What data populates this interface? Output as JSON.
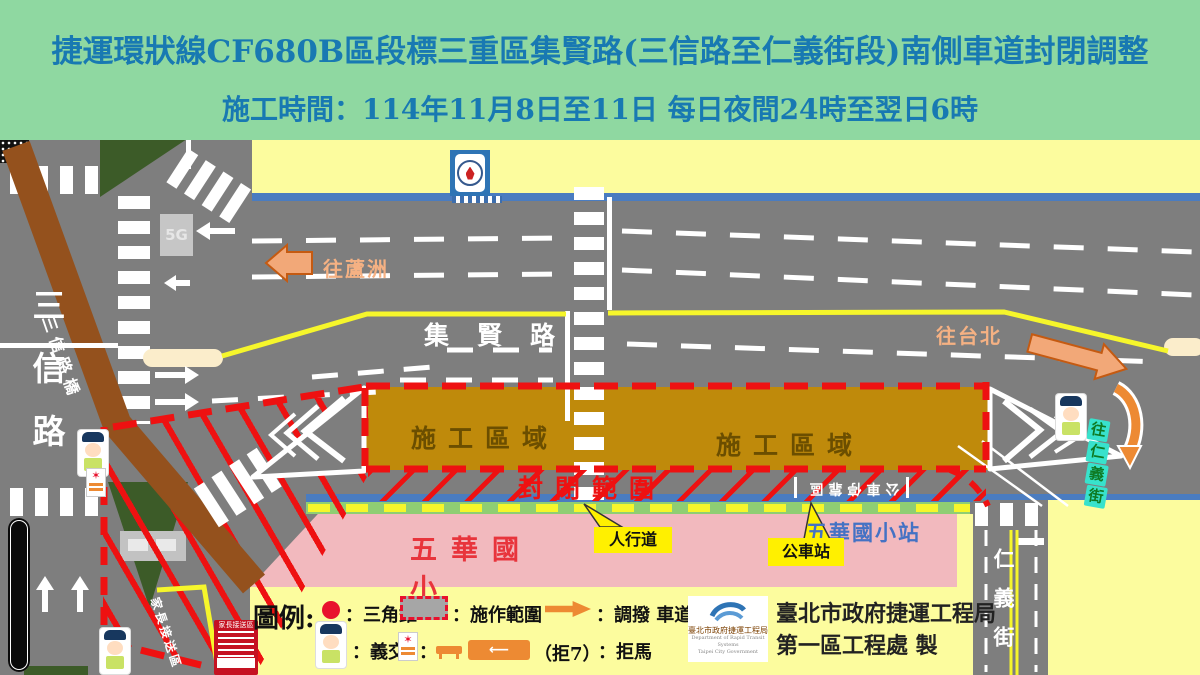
{
  "header": {
    "line1": "捷運環狀線CF680B區段標三重區集賢路(三信路至仁義街段)南側車道封閉調整",
    "line2": "施工時間：114年11月8日至11日  每日夜間24時至翌日6時"
  },
  "roads": {
    "jixian": "集賢路",
    "sanxin_vertical": "三信路",
    "sanxin_bridge": "三信路橋",
    "renyi_vertical": "仁義街",
    "to_luzhou": "往蘆洲",
    "to_taipei": "往台北",
    "to_renyi_chars": [
      "往",
      "仁",
      "義",
      "街"
    ],
    "bus_bay": "公車停靠區",
    "parent_pickup_road": "家長接送區"
  },
  "zones": {
    "construction": "施工區域",
    "closure": "封閉範圍",
    "school": "五華國小",
    "bus_stop_name": "五華國小站"
  },
  "callouts": {
    "sidewalk": "人行道",
    "bus_stop": "公車站"
  },
  "signs": {
    "corner_box": "5G",
    "parent_pickup_sign": "家長接送區"
  },
  "legend": {
    "title": "圖例:",
    "cone_label": "：三角錐",
    "work_area_label": "：施作範圍",
    "lane_shift_label": "：調撥  車道",
    "police_label": "：義交",
    "colon": "：",
    "barrier_paren": "（拒7）",
    "barrier_label": "：拒馬"
  },
  "org": {
    "line1": "臺北市政府捷運工程局",
    "line2": "第一區工程處 製",
    "logo_title": "臺北市政府捷運工程局",
    "logo_en1": "Department of Rapid Transit Systems",
    "logo_en2": "Taipei City Government"
  },
  "colors": {
    "header_bg": "#8FD8A1",
    "header_fg": "#1879B2",
    "road_gray": "#7E7E7E",
    "construction_gold": "#BF8A0B",
    "closure_red": "#EE1111",
    "school_pink": "#F2B9BE",
    "block_yellow": "#FCFC9E",
    "sidewalk_blue": "#4A7CC0",
    "sidewalk_green": "#8FCE73",
    "bridge_brown": "#94511D",
    "arrow_orange": "#ED8A33",
    "direction_text_orange": "#F5B183",
    "cyan_sign": "#38E2CC"
  }
}
